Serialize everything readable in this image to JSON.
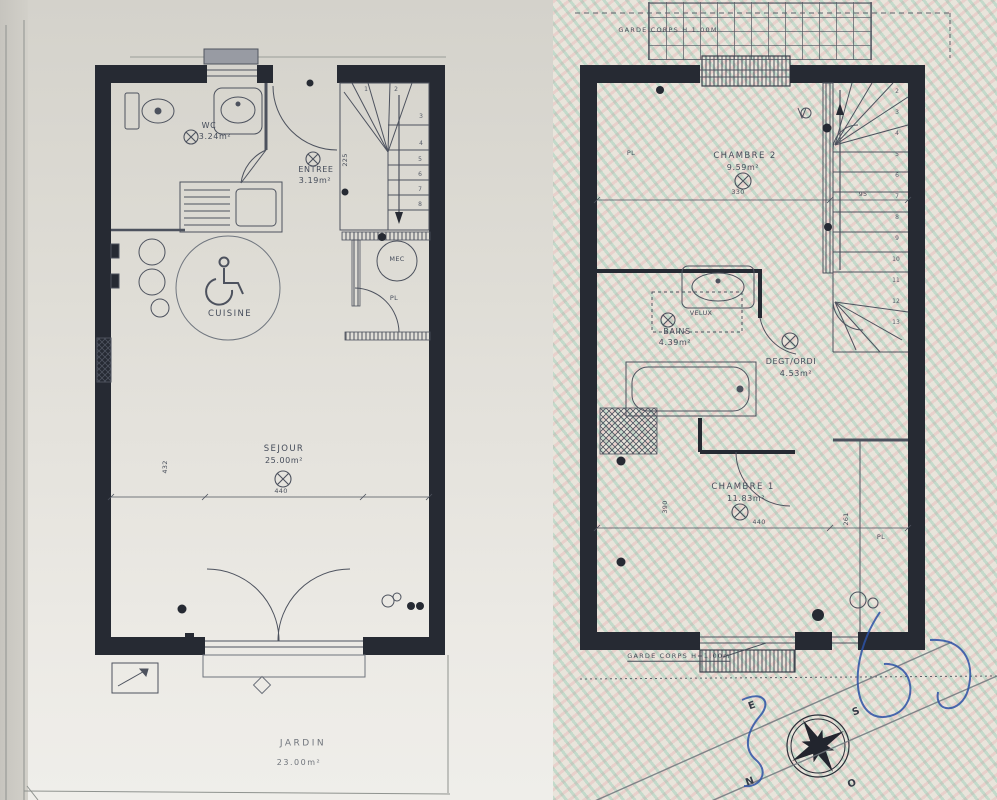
{
  "ground_floor": {
    "wc": {
      "label": "WC",
      "area": "3.24m²"
    },
    "entree": {
      "label": "ENTREE",
      "area": "3.19m²"
    },
    "cuisine": {
      "label": "CUISINE"
    },
    "sejour": {
      "label": "SEJOUR",
      "area": "25.00m²"
    },
    "mec_label": "MEC",
    "pl_label": "PL",
    "dims": {
      "width": "440",
      "height": "432",
      "entry_depth": "225"
    },
    "stair_numbers": [
      "1",
      "2",
      "3",
      "4",
      "5",
      "6",
      "7",
      "8"
    ],
    "jardin": {
      "label": "JARDIN",
      "area": "23.00m²"
    }
  },
  "first_floor": {
    "garde_corps_top": "GARDE CORPS H 1.00M",
    "garde_corps_bottom": "GARDE CORPS H=1.00m",
    "chambre2": {
      "label": "CHAMBRE 2",
      "area": "9.59m²",
      "pl": "PL",
      "dim_width": "330",
      "dim_stair": "95"
    },
    "bains": {
      "label": "BAINS",
      "area": "4.39m²",
      "velux": "VELUX"
    },
    "degt": {
      "label": "DEGT/ORDI",
      "area": "4.53m²"
    },
    "chambre1": {
      "label": "CHAMBRE 1",
      "area": "11.83m²",
      "pl": "PL",
      "dim_width": "440",
      "dim_right": "261",
      "dim_left": "390"
    },
    "stair_numbers": [
      "2",
      "3",
      "4",
      "5",
      "6",
      "7",
      "8",
      "9",
      "10",
      "11",
      "12",
      "13"
    ]
  },
  "compass": {
    "n": "N",
    "s": "S",
    "e": "E",
    "o": "O"
  },
  "colors": {
    "wall": "#262a33",
    "line": "#4d525e",
    "paper": "#e3e0d8",
    "moire_teal": "#7fcbb4",
    "moire_pink": "#e8b9bd",
    "pen_blue": "#2d52a6"
  }
}
